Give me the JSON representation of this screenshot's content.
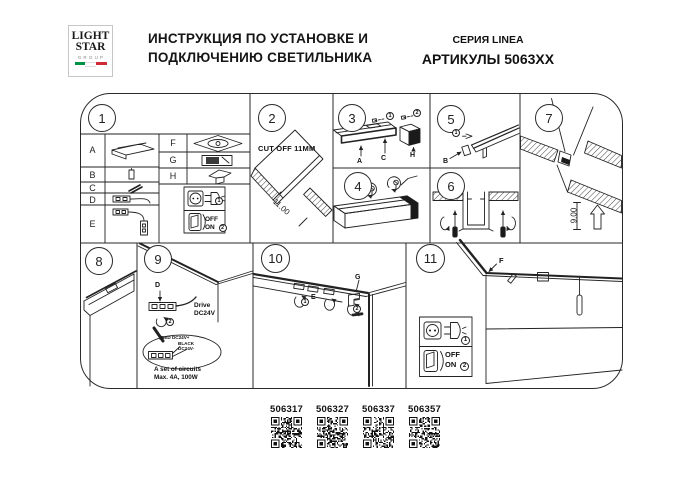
{
  "logo": {
    "line1": "LIGHT",
    "line2": "STAR",
    "line3": "GROUP"
  },
  "header": {
    "title_line1": "ИНСТРУКЦИЯ ПО УСТАНОВКЕ И",
    "title_line2": "ПОДКЛЮЧЕНИЮ СВЕТИЛЬНИКА",
    "series": "СЕРИЯ LINEA",
    "articles": "АРТИКУЛЫ 5063XX"
  },
  "panels": {
    "n1": "1",
    "n2": "2",
    "n3": "3",
    "n4": "4",
    "n5": "5",
    "n6": "6",
    "n7": "7",
    "n8": "8",
    "n9": "9",
    "n10": "10",
    "n11": "11"
  },
  "parts": {
    "a": "A",
    "b": "B",
    "c": "C",
    "d": "D",
    "e": "E",
    "f": "F",
    "g": "G",
    "h": "H"
  },
  "power": {
    "step1": "1",
    "step2": "2",
    "off": "OFF",
    "on": "ON"
  },
  "p2": {
    "note": "CUT OFF 11MM",
    "dim": "11.00"
  },
  "p3": {
    "step1": "1",
    "step2": "2",
    "label_a": "A",
    "label_c": "C",
    "label_h": "H"
  },
  "p5": {
    "step1": "1",
    "label_b": "B"
  },
  "p7": {
    "dim": "9.00"
  },
  "p9": {
    "label_d": "D",
    "step2": "2",
    "drive_line1": "Drive",
    "drive_line2": "DC24V",
    "wire_red": "RED DC24V+",
    "wire_black1": "BLACK",
    "wire_black2": "DC24V-",
    "circuits_line1": "A set of circuits",
    "circuits_line2": "Max. 4A, 100W"
  },
  "p10": {
    "label_e": "E",
    "label_g": "G",
    "step1": "1",
    "step2": "2"
  },
  "p11": {
    "label_f": "F"
  },
  "qr": [
    "506317",
    "506327",
    "506337",
    "506357"
  ],
  "colors": {
    "line": "#222222",
    "flag_green": "#009246",
    "flag_red": "#ce2b37",
    "logo_gray": "#8a8a8a"
  }
}
